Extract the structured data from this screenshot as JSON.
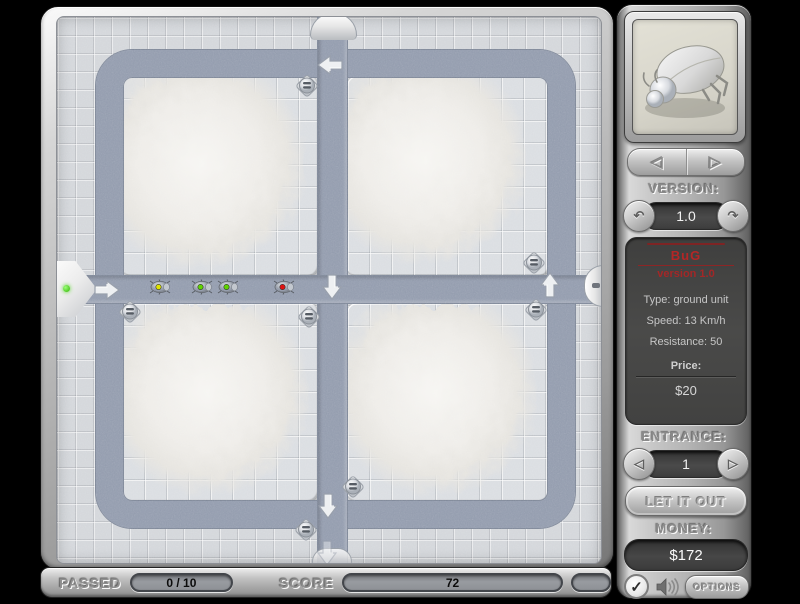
{
  "hud": {
    "passed_label": "PASSED",
    "passed_value": "0 / 10",
    "score_label": "SCORE",
    "score_value": "72"
  },
  "sidebar": {
    "unit_nav": {
      "prev": "◁",
      "next": "▷"
    },
    "version_label": "VERSION:",
    "version_value": "1.0",
    "version_down": "↶",
    "version_up": "↷",
    "info": {
      "name": "BuG",
      "version": "version 1.0",
      "type": "Type: ground unit",
      "speed": "Speed: 13 Km/h",
      "resistance": "Resistance: 50",
      "price_label": "Price:",
      "price_value": "$20"
    },
    "entrance_label": "ENTRANCE:",
    "entrance_value": "1",
    "entrance_prev": "◁",
    "entrance_next": "▷",
    "release_button": "LET IT OUT",
    "money_label": "MONEY:",
    "money_value": "$172",
    "options_button": "OPTIONS",
    "check_glyph": "✓"
  },
  "board": {
    "colors": {
      "path": "#939cae",
      "tile": "#d4d7db",
      "accent_red": "#b42626"
    },
    "bugs": [
      {
        "x": 103,
        "y": 270,
        "color": "#dfe400"
      },
      {
        "x": 145,
        "y": 270,
        "color": "#5fd400"
      },
      {
        "x": 171,
        "y": 270,
        "color": "#5fd400"
      },
      {
        "x": 227,
        "y": 270,
        "color": "#e01212"
      }
    ],
    "turrets": [
      {
        "x": 250,
        "y": 69
      },
      {
        "x": 477,
        "y": 246
      },
      {
        "x": 73,
        "y": 295
      },
      {
        "x": 252,
        "y": 300
      },
      {
        "x": 479,
        "y": 293
      },
      {
        "x": 296,
        "y": 470
      },
      {
        "x": 249,
        "y": 513
      }
    ],
    "arrows": [
      {
        "x": 50,
        "y": 273,
        "dir": "right",
        "faint": false
      },
      {
        "x": 273,
        "y": 48,
        "dir": "left",
        "faint": false
      },
      {
        "x": 275,
        "y": 270,
        "dir": "down",
        "faint": false
      },
      {
        "x": 493,
        "y": 268,
        "dir": "up",
        "faint": false
      },
      {
        "x": 271,
        "y": 489,
        "dir": "down",
        "faint": false
      },
      {
        "x": 270,
        "y": 536,
        "dir": "down",
        "faint": true
      }
    ]
  }
}
